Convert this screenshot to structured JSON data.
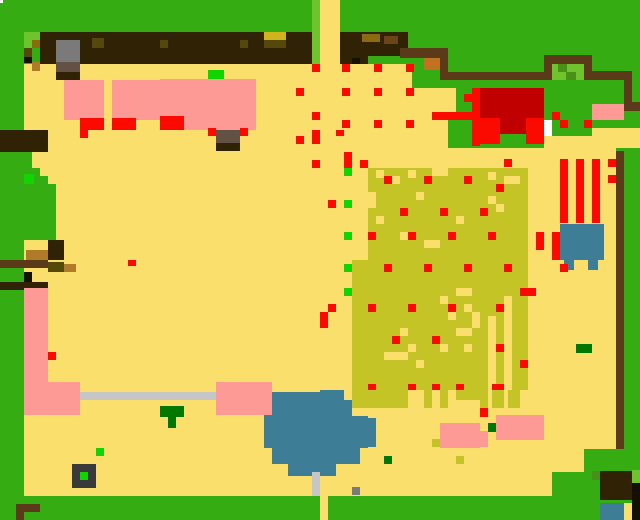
{
  "map": {
    "title": "pixel-farm-map",
    "width": 640,
    "height": 520,
    "palette": {
      "grass": "#35ad12",
      "grassLight": "#6fc32c",
      "grassMid": "#4a9018",
      "sand": "#fbdf6d",
      "canopy": "#2f2205",
      "brown": "#5a3a18",
      "brown2": "#6b4418",
      "tan": "#b07b28",
      "dijon": "#8a6b10",
      "olive": "#54490a",
      "gold": "#d1b31b",
      "crop": "#c4c426",
      "orange": "#c07122",
      "red": "#fa0a00",
      "darkRed": "#c00000",
      "pink": "#fd9a95",
      "lime": "#11d500",
      "darkGreen": "#007700",
      "gray": "#7a7a7a",
      "taupe": "#645146",
      "silver": "#c6c6c6",
      "water": "#3e7d96",
      "black": "#141006",
      "charcoal": "#3a3a3a",
      "white": "#ffffff"
    },
    "rects": [
      [
        0,
        0,
        640,
        520,
        "grass"
      ],
      [
        24,
        64,
        592,
        432,
        "sand"
      ],
      [
        40,
        32,
        272,
        32,
        "canopy"
      ],
      [
        312,
        0,
        8,
        64,
        "grassLight"
      ],
      [
        320,
        0,
        20,
        64,
        "sand"
      ],
      [
        340,
        32,
        68,
        24,
        "canopy"
      ],
      [
        340,
        56,
        28,
        8,
        "canopy"
      ],
      [
        362,
        34,
        18,
        8,
        "dijon"
      ],
      [
        384,
        36,
        14,
        8,
        "brown2"
      ],
      [
        352,
        58,
        8,
        6,
        "black"
      ],
      [
        24,
        32,
        16,
        8,
        "grassLight"
      ],
      [
        24,
        40,
        8,
        8,
        "grassLight"
      ],
      [
        32,
        40,
        8,
        8,
        "dijon"
      ],
      [
        24,
        48,
        8,
        9,
        "olive"
      ],
      [
        24,
        57,
        8,
        6,
        "black"
      ],
      [
        32,
        62,
        8,
        9,
        "tan"
      ],
      [
        92,
        38,
        12,
        10,
        "olive"
      ],
      [
        160,
        40,
        8,
        8,
        "olive"
      ],
      [
        240,
        40,
        8,
        8,
        "olive"
      ],
      [
        264,
        32,
        22,
        8,
        "gold"
      ],
      [
        264,
        40,
        22,
        8,
        "olive"
      ],
      [
        56,
        40,
        24,
        22,
        "gray"
      ],
      [
        56,
        62,
        24,
        10,
        "taupe"
      ],
      [
        56,
        72,
        24,
        8,
        "canopy"
      ],
      [
        408,
        0,
        232,
        64,
        "grass"
      ],
      [
        448,
        64,
        176,
        84,
        "grass"
      ],
      [
        412,
        58,
        36,
        30,
        "grass"
      ],
      [
        424,
        56,
        16,
        14,
        "orange"
      ],
      [
        442,
        88,
        14,
        24,
        "sand"
      ],
      [
        592,
        128,
        48,
        20,
        "sand"
      ],
      [
        544,
        136,
        96,
        12,
        "sand"
      ],
      [
        400,
        48,
        48,
        10,
        "brown"
      ],
      [
        440,
        56,
        8,
        24,
        "brown"
      ],
      [
        448,
        72,
        144,
        8,
        "brown"
      ],
      [
        544,
        55,
        48,
        9,
        "brown"
      ],
      [
        544,
        55,
        8,
        25,
        "brown"
      ],
      [
        584,
        55,
        8,
        25,
        "brown"
      ],
      [
        552,
        64,
        32,
        16,
        "grassLight"
      ],
      [
        558,
        64,
        9,
        8,
        "grassMid"
      ],
      [
        566,
        72,
        10,
        8,
        "grassMid"
      ],
      [
        592,
        71,
        40,
        9,
        "brown"
      ],
      [
        624,
        71,
        8,
        40,
        "brown"
      ],
      [
        632,
        102,
        8,
        9,
        "brown"
      ],
      [
        480,
        88,
        64,
        46,
        "darkRed"
      ],
      [
        472,
        88,
        8,
        48,
        "red"
      ],
      [
        432,
        112,
        48,
        8,
        "red"
      ],
      [
        480,
        118,
        20,
        26,
        "red"
      ],
      [
        526,
        118,
        18,
        26,
        "red"
      ],
      [
        500,
        134,
        26,
        10,
        "grass"
      ],
      [
        544,
        120,
        8,
        16,
        "white"
      ],
      [
        552,
        112,
        8,
        8,
        "red"
      ],
      [
        560,
        120,
        8,
        8,
        "red"
      ],
      [
        584,
        120,
        8,
        8,
        "red"
      ],
      [
        592,
        104,
        32,
        16,
        "pink"
      ],
      [
        616,
        151,
        8,
        298,
        "brown"
      ],
      [
        624,
        159,
        16,
        231,
        "grass"
      ],
      [
        560,
        159,
        8,
        64,
        "red"
      ],
      [
        576,
        159,
        8,
        64,
        "red"
      ],
      [
        592,
        159,
        8,
        64,
        "red"
      ],
      [
        608,
        159,
        8,
        8,
        "red"
      ],
      [
        608,
        175,
        8,
        8,
        "red"
      ],
      [
        504,
        159,
        8,
        8,
        "red"
      ],
      [
        560,
        224,
        44,
        36,
        "water"
      ],
      [
        564,
        260,
        10,
        10,
        "water"
      ],
      [
        588,
        260,
        10,
        10,
        "water"
      ],
      [
        552,
        232,
        8,
        28,
        "red"
      ],
      [
        536,
        232,
        8,
        18,
        "red"
      ],
      [
        0,
        130,
        48,
        22,
        "canopy"
      ],
      [
        24,
        152,
        8,
        8,
        "grass"
      ],
      [
        24,
        160,
        8,
        80,
        "grass"
      ],
      [
        32,
        168,
        8,
        72,
        "grass"
      ],
      [
        40,
        176,
        8,
        64,
        "grass"
      ],
      [
        48,
        184,
        8,
        56,
        "grass"
      ],
      [
        24,
        174,
        10,
        10,
        "lime"
      ],
      [
        48,
        240,
        16,
        20,
        "canopy"
      ],
      [
        26,
        250,
        22,
        10,
        "tan"
      ],
      [
        0,
        260,
        48,
        8,
        "brown"
      ],
      [
        48,
        262,
        16,
        10,
        "olive"
      ],
      [
        64,
        264,
        12,
        8,
        "tan"
      ],
      [
        24,
        272,
        8,
        10,
        "black"
      ],
      [
        0,
        282,
        48,
        8,
        "canopy"
      ],
      [
        64,
        80,
        40,
        40,
        "pink"
      ],
      [
        112,
        80,
        48,
        40,
        "pink"
      ],
      [
        160,
        79,
        96,
        51,
        "pink"
      ],
      [
        208,
        70,
        16,
        9,
        "lime"
      ],
      [
        80,
        118,
        24,
        12,
        "red"
      ],
      [
        112,
        118,
        24,
        12,
        "red"
      ],
      [
        160,
        116,
        24,
        14,
        "red"
      ],
      [
        216,
        130,
        24,
        13,
        "taupe"
      ],
      [
        216,
        143,
        24,
        8,
        "canopy"
      ],
      [
        208,
        128,
        8,
        8,
        "red"
      ],
      [
        240,
        128,
        8,
        8,
        "red"
      ],
      [
        80,
        130,
        8,
        8,
        "red"
      ],
      [
        24,
        288,
        24,
        96,
        "pink"
      ],
      [
        24,
        382,
        56,
        33,
        "pink"
      ],
      [
        48,
        352,
        8,
        8,
        "red"
      ],
      [
        128,
        260,
        8,
        6,
        "red"
      ],
      [
        80,
        392,
        136,
        8,
        "silver"
      ],
      [
        160,
        406,
        24,
        11,
        "darkGreen"
      ],
      [
        168,
        417,
        8,
        11,
        "darkGreen"
      ],
      [
        96,
        448,
        8,
        8,
        "lime"
      ],
      [
        72,
        464,
        24,
        24,
        "charcoal"
      ],
      [
        80,
        472,
        8,
        8,
        "lime"
      ],
      [
        16,
        504,
        24,
        8,
        "brown"
      ],
      [
        16,
        512,
        8,
        8,
        "brown"
      ],
      [
        0,
        0,
        3,
        3,
        "white"
      ],
      [
        368,
        168,
        160,
        92,
        "crop"
      ],
      [
        352,
        260,
        176,
        130,
        "crop"
      ],
      [
        352,
        390,
        56,
        18,
        "crop"
      ],
      [
        424,
        390,
        8,
        18,
        "crop"
      ],
      [
        440,
        390,
        8,
        18,
        "crop"
      ],
      [
        456,
        390,
        24,
        10,
        "crop"
      ],
      [
        480,
        390,
        8,
        18,
        "crop"
      ],
      [
        492,
        390,
        12,
        18,
        "crop"
      ],
      [
        508,
        390,
        12,
        18,
        "crop"
      ],
      [
        376,
        170,
        8,
        8,
        "sand"
      ],
      [
        392,
        176,
        8,
        8,
        "sand"
      ],
      [
        408,
        170,
        8,
        8,
        "sand"
      ],
      [
        424,
        176,
        8,
        8,
        "sand"
      ],
      [
        432,
        168,
        16,
        8,
        "sand"
      ],
      [
        368,
        192,
        8,
        16,
        "sand"
      ],
      [
        416,
        192,
        8,
        8,
        "sand"
      ],
      [
        376,
        216,
        8,
        8,
        "sand"
      ],
      [
        400,
        232,
        8,
        8,
        "sand"
      ],
      [
        456,
        216,
        8,
        8,
        "sand"
      ],
      [
        424,
        240,
        16,
        8,
        "sand"
      ],
      [
        488,
        172,
        8,
        8,
        "sand"
      ],
      [
        504,
        176,
        16,
        8,
        "sand"
      ],
      [
        488,
        196,
        8,
        8,
        "sand"
      ],
      [
        496,
        204,
        8,
        8,
        "sand"
      ],
      [
        456,
        288,
        16,
        8,
        "sand"
      ],
      [
        440,
        296,
        8,
        8,
        "sand"
      ],
      [
        464,
        304,
        8,
        8,
        "sand"
      ],
      [
        448,
        312,
        8,
        8,
        "sand"
      ],
      [
        472,
        312,
        8,
        16,
        "sand"
      ],
      [
        456,
        328,
        16,
        8,
        "sand"
      ],
      [
        440,
        344,
        8,
        8,
        "sand"
      ],
      [
        464,
        344,
        8,
        8,
        "sand"
      ],
      [
        400,
        328,
        8,
        8,
        "sand"
      ],
      [
        408,
        344,
        8,
        8,
        "sand"
      ],
      [
        384,
        352,
        24,
        8,
        "sand"
      ],
      [
        416,
        360,
        8,
        8,
        "sand"
      ],
      [
        488,
        316,
        8,
        74,
        "sand"
      ],
      [
        504,
        296,
        8,
        94,
        "sand"
      ],
      [
        272,
        392,
        48,
        8,
        "water"
      ],
      [
        320,
        390,
        24,
        10,
        "water"
      ],
      [
        264,
        400,
        88,
        16,
        "water"
      ],
      [
        264,
        416,
        104,
        32,
        "water"
      ],
      [
        368,
        418,
        8,
        29,
        "water"
      ],
      [
        272,
        448,
        88,
        16,
        "water"
      ],
      [
        288,
        464,
        48,
        12,
        "water"
      ],
      [
        312,
        472,
        8,
        24,
        "silver"
      ],
      [
        352,
        487,
        8,
        8,
        "gray"
      ],
      [
        216,
        382,
        56,
        33,
        "pink"
      ],
      [
        440,
        423,
        40,
        25,
        "pink"
      ],
      [
        496,
        415,
        48,
        25,
        "pink"
      ],
      [
        480,
        431,
        8,
        16,
        "pink"
      ],
      [
        488,
        423,
        8,
        9,
        "darkGreen"
      ],
      [
        432,
        439,
        8,
        8,
        "crop"
      ],
      [
        456,
        456,
        8,
        8,
        "crop"
      ],
      [
        384,
        456,
        8,
        8,
        "darkGreen"
      ],
      [
        480,
        408,
        8,
        9,
        "red"
      ],
      [
        584,
        449,
        56,
        47,
        "grass"
      ],
      [
        552,
        472,
        64,
        24,
        "grass"
      ],
      [
        632,
        470,
        8,
        13,
        "grassLight"
      ],
      [
        592,
        471,
        8,
        9,
        "grassMid"
      ],
      [
        600,
        471,
        32,
        29,
        "canopy"
      ],
      [
        632,
        483,
        8,
        17,
        "black"
      ],
      [
        600,
        503,
        24,
        17,
        "water"
      ],
      [
        624,
        503,
        8,
        17,
        "sand"
      ],
      [
        632,
        500,
        8,
        20,
        "black"
      ],
      [
        576,
        344,
        16,
        9,
        "darkGreen"
      ],
      [
        320,
        496,
        8,
        24,
        "sand"
      ],
      [
        520,
        288,
        16,
        8,
        "red"
      ],
      [
        520,
        360,
        8,
        8,
        "red"
      ],
      [
        496,
        344,
        8,
        8,
        "red"
      ],
      [
        496,
        304,
        8,
        8,
        "red"
      ],
      [
        496,
        384,
        8,
        6,
        "red"
      ],
      [
        504,
        264,
        8,
        8,
        "red"
      ],
      [
        560,
        264,
        8,
        8,
        "red"
      ],
      [
        312,
        64,
        8,
        8,
        "red"
      ],
      [
        342,
        64,
        8,
        8,
        "red"
      ],
      [
        374,
        64,
        8,
        8,
        "red"
      ],
      [
        406,
        64,
        8,
        8,
        "red"
      ],
      [
        296,
        88,
        8,
        8,
        "red"
      ],
      [
        342,
        88,
        8,
        8,
        "red"
      ],
      [
        374,
        88,
        8,
        8,
        "red"
      ],
      [
        406,
        88,
        8,
        8,
        "red"
      ],
      [
        464,
        94,
        8,
        8,
        "red"
      ],
      [
        312,
        112,
        8,
        8,
        "red"
      ],
      [
        342,
        120,
        8,
        8,
        "red"
      ],
      [
        374,
        120,
        8,
        8,
        "red"
      ],
      [
        406,
        120,
        8,
        8,
        "red"
      ],
      [
        296,
        136,
        8,
        8,
        "red"
      ],
      [
        312,
        136,
        8,
        8,
        "red"
      ],
      [
        472,
        132,
        8,
        14,
        "red"
      ],
      [
        336,
        130,
        8,
        6,
        "red"
      ],
      [
        312,
        130,
        8,
        6,
        "red"
      ],
      [
        312,
        160,
        8,
        8,
        "red"
      ],
      [
        360,
        160,
        8,
        8,
        "red"
      ],
      [
        344,
        152,
        8,
        16,
        "red"
      ],
      [
        328,
        200,
        8,
        8,
        "red"
      ],
      [
        320,
        312,
        8,
        16,
        "red"
      ],
      [
        328,
        304,
        8,
        8,
        "red"
      ],
      [
        344,
        168,
        8,
        8,
        "lime"
      ],
      [
        344,
        200,
        8,
        8,
        "lime"
      ],
      [
        344,
        232,
        8,
        8,
        "lime"
      ],
      [
        344,
        264,
        8,
        8,
        "lime"
      ],
      [
        344,
        288,
        8,
        8,
        "lime"
      ],
      [
        384,
        176,
        8,
        8,
        "red"
      ],
      [
        424,
        176,
        8,
        8,
        "red"
      ],
      [
        464,
        176,
        8,
        8,
        "red"
      ],
      [
        496,
        184,
        8,
        8,
        "red"
      ],
      [
        400,
        208,
        8,
        8,
        "red"
      ],
      [
        440,
        208,
        8,
        8,
        "red"
      ],
      [
        480,
        208,
        8,
        8,
        "red"
      ],
      [
        368,
        232,
        8,
        8,
        "red"
      ],
      [
        408,
        232,
        8,
        8,
        "red"
      ],
      [
        448,
        232,
        8,
        8,
        "red"
      ],
      [
        488,
        232,
        8,
        8,
        "red"
      ],
      [
        384,
        264,
        8,
        8,
        "red"
      ],
      [
        424,
        264,
        8,
        8,
        "red"
      ],
      [
        464,
        264,
        8,
        8,
        "red"
      ],
      [
        368,
        304,
        8,
        8,
        "red"
      ],
      [
        408,
        304,
        8,
        8,
        "red"
      ],
      [
        448,
        304,
        8,
        8,
        "red"
      ],
      [
        392,
        336,
        8,
        8,
        "red"
      ],
      [
        432,
        336,
        8,
        8,
        "red"
      ],
      [
        368,
        384,
        8,
        6,
        "red"
      ],
      [
        408,
        384,
        8,
        6,
        "red"
      ],
      [
        432,
        384,
        8,
        6,
        "red"
      ],
      [
        456,
        384,
        8,
        6,
        "red"
      ],
      [
        492,
        384,
        8,
        6,
        "red"
      ]
    ]
  }
}
